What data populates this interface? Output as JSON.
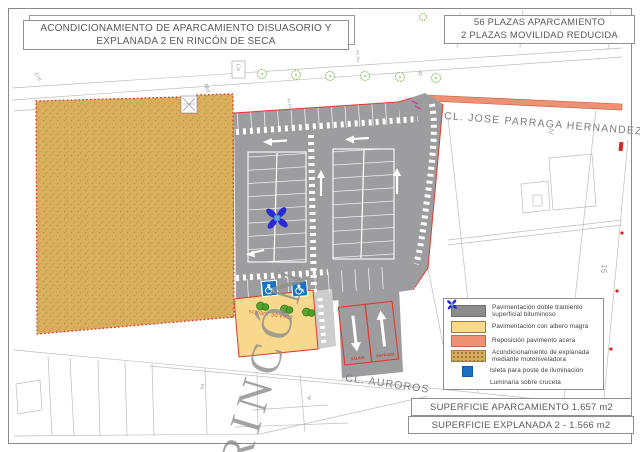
{
  "title_box": {
    "line1": "ACONDICIONAMIENTO DE APARCAMIENTO DISUASORIO Y",
    "line2": "EXPLANADA 2 EN RINCÓN DE SECA"
  },
  "capacity_box": {
    "line1": "56 PLAZAS APARCAMIENTO",
    "line2": "2 PLAZAS MOVILIDAD REDUCIDA"
  },
  "surface_boxes": {
    "aparcamiento": "SUPERFICIE APARCAMIENTO 1.657 m2",
    "explanada": "SUPERFICIE EXPLANADA 2 - 1.566 m2"
  },
  "streets": {
    "jose_parraga": "CL. JOSE PARRAGA HERNANDEZ",
    "auroros": "CL. AUROROS"
  },
  "watermark": "RINCÓN",
  "plan_labels": {
    "zona_juegos": "ZONA DE JUEGOS",
    "salida": "SALIDA",
    "entrada": "ENTRADA",
    "fru": "Fru",
    "mal": "Mal",
    "ca": "Ca",
    "no_pre_1": "No Pre",
    "no_pre_2": "No Pre",
    "num_6": "6",
    "roman_iv": "IV",
    "num_15": "15",
    "num_4": "4",
    "num_2": "2"
  },
  "legend": {
    "items": [
      {
        "name": "bituminoso",
        "color": "#8c8c8c",
        "label": "Pavimentación doble tramiento superficial bituminoso"
      },
      {
        "name": "albero",
        "color": "#fbd98a",
        "label": "Pavimentación con albero magra"
      },
      {
        "name": "acera",
        "color": "#ef9173",
        "label": "Reposición pavimento acera"
      },
      {
        "name": "explanada",
        "color": "#d8ae5e",
        "speckled": true,
        "label": "Acondicionamiento de explanada mediante motoniveladora"
      },
      {
        "name": "isleta",
        "color": "#1a73c2",
        "label": "Isleta para poste de iluminación"
      },
      {
        "name": "luminaria",
        "color": "#2a2ad2",
        "label": "Luminaria sobre cruceta"
      }
    ]
  },
  "colors": {
    "parking_gray": "#9d9da0",
    "explanada_tan": "#d9ae5c",
    "albero_yellow": "#f8d88c",
    "acera_salmon": "#ec9272",
    "sidewalk_gray": "#cdcdcd",
    "boundary_red": "#e0392e",
    "isleta_blue": "#1a73c2",
    "luminaria_blue": "#2a2ad2",
    "tree_green": "#7ab648",
    "bush_green": "#57a82e",
    "cadastre_gray": "#bdbdbd"
  }
}
